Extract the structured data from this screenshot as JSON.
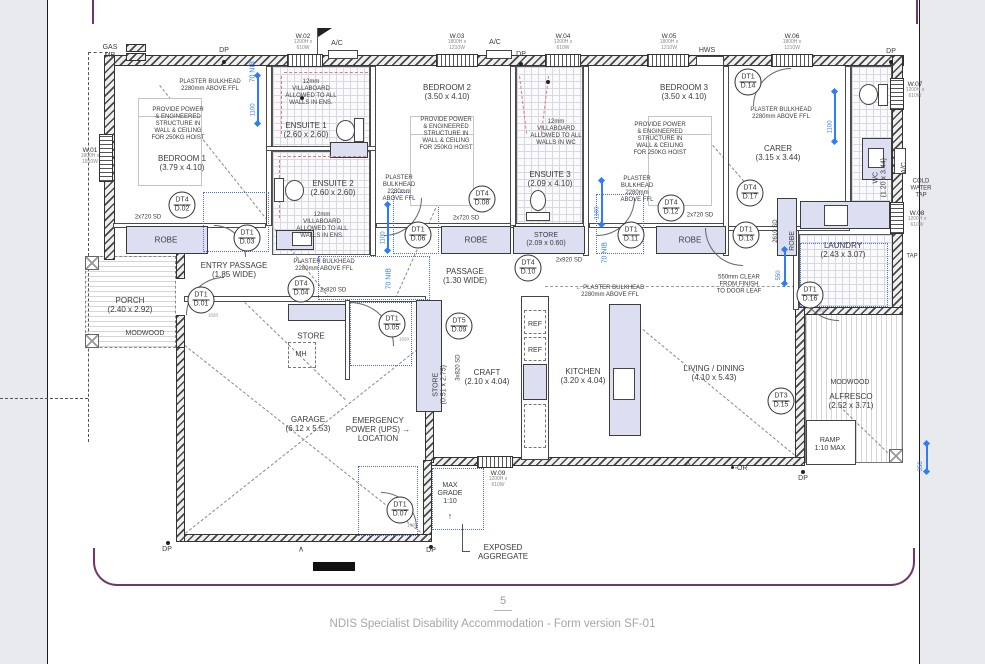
{
  "page": {
    "footer_page_number": "5",
    "footer_text": "NDIS Specialist Disability Accommodation - Form version SF-01",
    "colors": {
      "accent_purple": "#72366b",
      "dimension_blue": "#2f7df6",
      "joinery_lavender": "#dcdef2",
      "footer_gray": "#a6a6a6"
    }
  },
  "plan": {
    "labels": [
      {
        "n": "room-bedroom-1",
        "l": [
          "BEDROOM 1",
          "(3.79 x 4.10)"
        ],
        "x": 182,
        "y": 163,
        "c": "s8"
      },
      {
        "n": "room-ensuite-1",
        "l": [
          "ENSUITE 1",
          "(2.60 x 2.60)"
        ],
        "x": 306,
        "y": 130,
        "c": "s8"
      },
      {
        "n": "room-ensuite-2",
        "l": [
          "ENSUITE 2",
          "(2.60 x 2.60)"
        ],
        "x": 333,
        "y": 188,
        "c": "s8"
      },
      {
        "n": "room-bedroom-2",
        "l": [
          "BEDROOM 2",
          "(3.50 x 4.10)"
        ],
        "x": 447,
        "y": 92,
        "c": "s8"
      },
      {
        "n": "room-ensuite-3",
        "l": [
          "ENSUITE 3",
          "(2.09 x 4.10)"
        ],
        "x": 550,
        "y": 179,
        "c": "s8"
      },
      {
        "n": "room-bedroom-3",
        "l": [
          "BEDROOM 3",
          "(3.50 x 4.10)"
        ],
        "x": 684,
        "y": 92,
        "c": "s8"
      },
      {
        "n": "room-carer",
        "l": [
          "CARER",
          "(3.15 x 3.44)"
        ],
        "x": 778,
        "y": 153,
        "c": "s8"
      },
      {
        "n": "room-wc",
        "l": [
          "WC",
          "(1.20 x 3.44)"
        ],
        "x": 869,
        "y": 150,
        "c": "s7",
        "rot": -90
      },
      {
        "n": "room-laundry",
        "l": [
          "LAUNDRY",
          "(2.43 x 3.07)"
        ],
        "x": 843,
        "y": 250,
        "c": "s8"
      },
      {
        "n": "room-store-mid",
        "l": [
          "STORE",
          "(2.09 x 0.60)"
        ],
        "x": 546,
        "y": 240,
        "c": "s7"
      },
      {
        "n": "robe-1",
        "l": [
          "ROBE"
        ],
        "x": 166,
        "y": 240,
        "c": "s8"
      },
      {
        "n": "robe-2",
        "l": [
          "ROBE"
        ],
        "x": 476,
        "y": 240,
        "c": "s8"
      },
      {
        "n": "robe-3",
        "l": [
          "ROBE"
        ],
        "x": 690,
        "y": 240,
        "c": "s8"
      },
      {
        "n": "robe-carer",
        "l": [
          "ROBE"
        ],
        "x": 787,
        "y": 227,
        "c": "s7",
        "rot": -90
      },
      {
        "n": "room-entry-passage",
        "l": [
          "ENTRY PASSAGE",
          "(1.85 WIDE)"
        ],
        "x": 234,
        "y": 270,
        "c": "s8"
      },
      {
        "n": "room-passage",
        "l": [
          "PASSAGE",
          "(1.30 WIDE)"
        ],
        "x": 465,
        "y": 276,
        "c": "s8"
      },
      {
        "n": "room-porch",
        "l": [
          "PORCH",
          "(2.40 x 2.92)"
        ],
        "x": 130,
        "y": 305,
        "c": "s8"
      },
      {
        "n": "modwood-left",
        "l": [
          "MODWOOD"
        ],
        "x": 145,
        "y": 334,
        "c": "s7"
      },
      {
        "n": "room-store-nook",
        "l": [
          "STORE"
        ],
        "x": 311,
        "y": 336,
        "c": "s8"
      },
      {
        "n": "mh",
        "l": [
          "MH"
        ],
        "x": 301,
        "y": 355,
        "c": "s7"
      },
      {
        "n": "room-store-tall",
        "l": [
          "STORE",
          "(0.51 x 2.75)"
        ],
        "x": 429,
        "y": 357,
        "c": "s7",
        "rot": -90
      },
      {
        "n": "room-craft",
        "l": [
          "CRAFT",
          "(2.10 x 4.04)"
        ],
        "x": 487,
        "y": 377,
        "c": "s8"
      },
      {
        "n": "room-kitchen",
        "l": [
          "KITCHEN",
          "(3.20 x 4.04)"
        ],
        "x": 583,
        "y": 376,
        "c": "s8"
      },
      {
        "n": "room-living-dining",
        "l": [
          "LIVING / DINING",
          "(4.10 x 5.43)"
        ],
        "x": 714,
        "y": 373,
        "c": "s8"
      },
      {
        "n": "room-alfresco",
        "l": [
          "ALFRESCO",
          "(2.52 x 3.71)"
        ],
        "x": 851,
        "y": 401,
        "c": "s8"
      },
      {
        "n": "modwood-right",
        "l": [
          "MODWOOD"
        ],
        "x": 850,
        "y": 383,
        "c": "s7"
      },
      {
        "n": "ramp",
        "l": [
          "RAMP",
          "1:10 MAX"
        ],
        "x": 830,
        "y": 445,
        "c": "s7"
      },
      {
        "n": "room-garage",
        "l": [
          "GARAGE",
          "(6.12 x 5.53)"
        ],
        "x": 308,
        "y": 424,
        "c": "s8"
      },
      {
        "n": "note-emergency-power",
        "l": [
          "EMERGENCY",
          "POWER (UPS) →",
          "LOCATION"
        ],
        "x": 378,
        "y": 430,
        "c": "s8"
      },
      {
        "n": "note-max-grade",
        "l": [
          "MAX",
          "GRADE",
          "1:10"
        ],
        "x": 450,
        "y": 494,
        "c": "s7"
      },
      {
        "n": "max-grade-arrow",
        "l": [
          "↑"
        ],
        "x": 450,
        "y": 516,
        "c": "s9"
      },
      {
        "n": "note-exposed-aggregate",
        "l": [
          "EXPOSED",
          "AGGREGATE"
        ],
        "x": 503,
        "y": 552,
        "c": "s8"
      },
      {
        "n": "note-plaster-bulkhead-1",
        "l": [
          "PLASTER BULKHEAD",
          "2280mm ABOVE FFL"
        ],
        "x": 210,
        "y": 86,
        "c": "s6"
      },
      {
        "n": "note-plaster-bulkhead-2",
        "l": [
          "PLASTER",
          "BULKHEAD",
          "2280mm",
          "ABOVE FFL"
        ],
        "x": 399,
        "y": 189,
        "c": "s6"
      },
      {
        "n": "note-plaster-bulkhead-3",
        "l": [
          "PLASTER BULKHEAD",
          "2280mm ABOVE FFL"
        ],
        "x": 324,
        "y": 266,
        "c": "s6"
      },
      {
        "n": "note-plaster-bulkhead-4",
        "l": [
          "PLASTER",
          "BULKHEAD",
          "2280mm",
          "ABOVE FFL"
        ],
        "x": 637,
        "y": 190,
        "c": "s6"
      },
      {
        "n": "note-plaster-bulkhead-5",
        "l": [
          "PLASTER BULKHEAD",
          "2280mm ABOVE FFL"
        ],
        "x": 781,
        "y": 114,
        "c": "s6"
      },
      {
        "n": "note-plaster-bulkhead-6",
        "l": [
          "← PLASTER BULKHEAD",
          "2280mm ABOVE FFL"
        ],
        "x": 610,
        "y": 292,
        "c": "s6"
      },
      {
        "n": "note-hoist-1",
        "l": [
          "PROVIDE POWER",
          "& ENGINEERED",
          "STRUCTURE IN",
          "WALL & CEILING",
          "FOR 250KG HOIST"
        ],
        "x": 178,
        "y": 124,
        "c": "s6"
      },
      {
        "n": "note-hoist-2",
        "l": [
          "PROVIDE POWER",
          "& ENGINEERED",
          "STRUCTURE IN",
          "WALL & CEILING",
          "FOR 250KG HOIST"
        ],
        "x": 446,
        "y": 134,
        "c": "s6"
      },
      {
        "n": "note-hoist-3",
        "l": [
          "PROVIDE POWER",
          "& ENGINEERED",
          "STRUCTURE IN",
          "WALL & CEILING",
          "FOR 250KG HOIST"
        ],
        "x": 660,
        "y": 139,
        "c": "s6"
      },
      {
        "n": "note-villaboard-ens1",
        "l": [
          "12mm",
          "VILLABOARD",
          "ALLOWED TO ALL",
          "WALLS IN ENS."
        ],
        "x": 311,
        "y": 93,
        "c": "s6"
      },
      {
        "n": "note-villaboard-ens2",
        "l": [
          "12mm",
          "VILLABOARD",
          "ALLOWED TO ALL",
          "WALLS IN ENS."
        ],
        "x": 322,
        "y": 226,
        "c": "s6"
      },
      {
        "n": "note-villaboard-wc",
        "l": [
          "12mm",
          "VILLABOARD",
          "ALLOWED TO ALL",
          "WALLS IN WC"
        ],
        "x": 556,
        "y": 133,
        "c": "s6"
      },
      {
        "n": "note-550-clear",
        "l": [
          "550mm CLEAR",
          "FROM FINISH",
          "TO DOOR LEAF"
        ],
        "x": 739,
        "y": 285,
        "c": "s6"
      },
      {
        "n": "note-cold-water-tap",
        "l": [
          "COLD",
          "WATER",
          "TAP"
        ],
        "x": 921,
        "y": 189,
        "c": "s6"
      },
      {
        "n": "note-tap",
        "l": [
          "TAP"
        ],
        "x": 912,
        "y": 257,
        "c": "s6"
      },
      {
        "n": "sd-robe-1",
        "l": [
          "2x720 SD"
        ],
        "x": 148,
        "y": 218,
        "c": "s6"
      },
      {
        "n": "sd-robe-2",
        "l": [
          "2x720 SD"
        ],
        "x": 466,
        "y": 219,
        "c": "s6"
      },
      {
        "n": "sd-robe-3",
        "l": [
          "2x720 SD"
        ],
        "x": 700,
        "y": 216,
        "c": "s6"
      },
      {
        "n": "sd-2x820",
        "l": [
          "2x820 SD"
        ],
        "x": 333,
        "y": 291,
        "c": "s6"
      },
      {
        "n": "sd-2x920",
        "l": [
          "2x920 SD"
        ],
        "x": 569,
        "y": 261,
        "c": "s6"
      },
      {
        "n": "sd-3x820",
        "l": [
          "3x820 SD"
        ],
        "x": 449,
        "y": 351,
        "c": "s6",
        "rot": -90
      },
      {
        "n": "sd-2610",
        "l": [
          "2610 SD"
        ],
        "x": 768,
        "y": 216,
        "c": "s6",
        "rot": -90
      },
      {
        "n": "gas-meter",
        "l": [
          "GAS",
          "MB"
        ],
        "x": 110,
        "y": 52,
        "c": "s7"
      },
      {
        "n": "dp-top-1",
        "l": [
          "DP"
        ],
        "x": 224,
        "y": 51,
        "c": "s7"
      },
      {
        "n": "ac-top-1",
        "l": [
          "A/C"
        ],
        "x": 337,
        "y": 44,
        "c": "s7"
      },
      {
        "n": "ac-top-2",
        "l": [
          "A/C"
        ],
        "x": 495,
        "y": 43,
        "c": "s7"
      },
      {
        "n": "dp-top-2",
        "l": [
          "DP"
        ],
        "x": 521,
        "y": 55,
        "c": "s7"
      },
      {
        "n": "hws",
        "l": [
          "HWS"
        ],
        "x": 707,
        "y": 51,
        "c": "s7"
      },
      {
        "n": "dp-top-3",
        "l": [
          "DP"
        ],
        "x": 891,
        "y": 52,
        "c": "s7"
      },
      {
        "n": "dp-bottom-1",
        "l": [
          "DP"
        ],
        "x": 167,
        "y": 550,
        "c": "s7"
      },
      {
        "n": "dp-bottom-2",
        "l": [
          "DP"
        ],
        "x": 431,
        "y": 551,
        "c": "s7"
      },
      {
        "n": "dp-bottom-3",
        "l": [
          "DP"
        ],
        "x": 803,
        "y": 479,
        "c": "s7"
      },
      {
        "n": "or-mark",
        "l": [
          "◦OR"
        ],
        "x": 741,
        "y": 469,
        "c": "s7"
      },
      {
        "n": "ref-1",
        "l": [
          "REF"
        ],
        "x": 535,
        "y": 325,
        "c": "s7"
      },
      {
        "n": "ref-2",
        "l": [
          "REF"
        ],
        "x": 535,
        "y": 351,
        "c": "s7"
      },
      {
        "n": "ac-right",
        "l": [
          "A/C"
        ],
        "x": 903,
        "y": 158,
        "c": "s7",
        "rot": -90
      },
      {
        "n": "nib-70-top",
        "l": [
          "70 NIB"
        ],
        "x": 247,
        "y": 57,
        "c": "s7 blue",
        "rot": -90
      },
      {
        "n": "nib-70-mid",
        "l": [
          "70 NIB"
        ],
        "x": 383,
        "y": 264,
        "c": "s7 blue",
        "rot": -90
      },
      {
        "n": "nib-70-right",
        "l": [
          "70 NIB"
        ],
        "x": 599,
        "y": 238,
        "c": "s7 blue",
        "rot": -90
      },
      {
        "n": "swing-mark-1",
        "l": [
          "∧"
        ],
        "x": 301,
        "y": 549,
        "c": "s8"
      },
      {
        "n": "swing-mark-2",
        "l": [
          "∧"
        ],
        "x": 688,
        "y": 463,
        "c": "s8"
      }
    ],
    "door_tags": [
      {
        "t": "DT1",
        "b": "D.01",
        "x": 201,
        "y": 300,
        "sub": "1020"
      },
      {
        "t": "DT4",
        "b": "D.02",
        "x": 182,
        "y": 205
      },
      {
        "t": "DT1",
        "b": "D.03",
        "x": 247,
        "y": 238
      },
      {
        "t": "DT4",
        "b": "D.04",
        "x": 301,
        "y": 289
      },
      {
        "t": "DT1",
        "b": "D.05",
        "x": 392,
        "y": 324,
        "sub": "1020"
      },
      {
        "t": "DT1",
        "b": "D.06",
        "x": 418,
        "y": 235
      },
      {
        "t": "DT1",
        "b": "D.07",
        "x": 400,
        "y": 510,
        "sub": "1020"
      },
      {
        "t": "DT4",
        "b": "D.08",
        "x": 482,
        "y": 199
      },
      {
        "t": "DT5",
        "b": "D.09",
        "x": 459,
        "y": 326
      },
      {
        "t": "DT4",
        "b": "D.10",
        "x": 528,
        "y": 268
      },
      {
        "t": "DT1",
        "b": "D.11",
        "x": 631,
        "y": 235
      },
      {
        "t": "DT4",
        "b": "D.12",
        "x": 671,
        "y": 208
      },
      {
        "t": "DT1",
        "b": "D.13",
        "x": 746,
        "y": 235
      },
      {
        "t": "DT1",
        "b": "D.14",
        "x": 748,
        "y": 82
      },
      {
        "t": "DT3",
        "b": "D.15",
        "x": 781,
        "y": 401
      },
      {
        "t": "DT1",
        "b": "D.16",
        "x": 810,
        "y": 295,
        "sub": "1020"
      },
      {
        "t": "DT4",
        "b": "D.17",
        "x": 750,
        "y": 193
      }
    ],
    "windows": [
      {
        "id": "W.01",
        "spec": "1800H x 1810W",
        "x": 99,
        "y": 134,
        "w": 14,
        "h": 48,
        "o": "v",
        "lx": 90,
        "ly": 156
      },
      {
        "id": "W.02",
        "spec": "1200H x 610W",
        "x": 287,
        "y": 54,
        "w": 36,
        "h": 13,
        "o": "h",
        "lx": 303,
        "ly": 42
      },
      {
        "id": "W.03",
        "spec": "1800H x 1210W",
        "x": 436,
        "y": 54,
        "w": 42,
        "h": 13,
        "o": "h",
        "lx": 457,
        "ly": 42
      },
      {
        "id": "W.04",
        "spec": "1200H x 610W",
        "x": 545,
        "y": 54,
        "w": 36,
        "h": 13,
        "o": "h",
        "lx": 563,
        "ly": 42
      },
      {
        "id": "W.05",
        "spec": "1800H x 1210W",
        "x": 647,
        "y": 54,
        "w": 42,
        "h": 13,
        "o": "h",
        "lx": 669,
        "ly": 42
      },
      {
        "id": "W.06",
        "spec": "1800H x 1210W",
        "x": 771,
        "y": 54,
        "w": 42,
        "h": 13,
        "o": "h",
        "lx": 792,
        "ly": 42
      },
      {
        "id": "W.07",
        "spec": "1200H x 610W",
        "x": 890,
        "y": 78,
        "w": 14,
        "h": 32,
        "o": "v",
        "lx": 915,
        "ly": 90
      },
      {
        "id": "W.08",
        "spec": "1200H x 610W",
        "x": 890,
        "y": 202,
        "w": 14,
        "h": 32,
        "o": "v",
        "lx": 917,
        "ly": 219
      },
      {
        "id": "W.09",
        "spec": "1200H x 610W",
        "x": 477,
        "y": 456,
        "w": 36,
        "h": 12,
        "o": "h",
        "lx": 498,
        "ly": 479
      }
    ],
    "dimensions": [
      {
        "t": "1100",
        "x": 257,
        "y": 76,
        "len": 48
      },
      {
        "t": "1100",
        "x": 387,
        "y": 205,
        "len": 46
      },
      {
        "t": "1100",
        "x": 601,
        "y": 181,
        "len": 44
      },
      {
        "t": "1100",
        "x": 834,
        "y": 92,
        "len": 50
      },
      {
        "t": "550",
        "x": 784,
        "y": 250,
        "len": 34
      },
      {
        "t": "350",
        "x": 926,
        "y": 444,
        "len": 28
      }
    ]
  }
}
